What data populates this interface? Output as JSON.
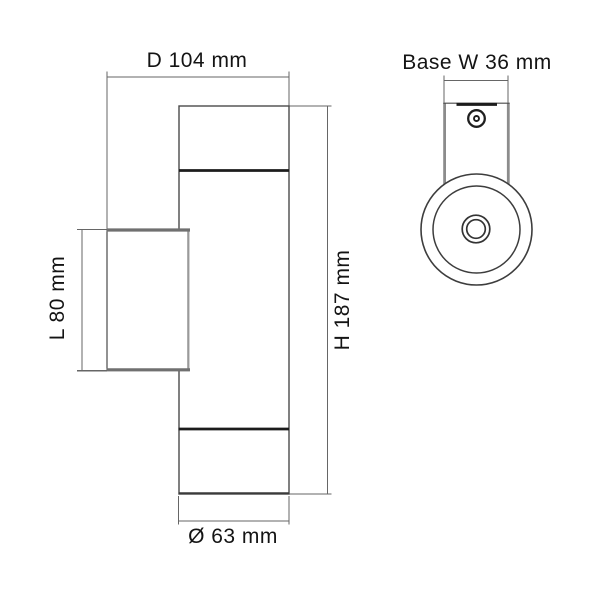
{
  "drawing": {
    "type": "technical-dimension-drawing",
    "subject": "cylindrical up-down wall luminaire, side view and front view",
    "side_view": {
      "dim_depth": "D 104 mm",
      "dim_length": "L 80 mm",
      "dim_height": "H 187 mm",
      "dim_diameter": "Ø 63 mm"
    },
    "front_view": {
      "dim_base_width": "Base W 36 mm"
    },
    "colors": {
      "background": "#ffffff",
      "outline": "#4a4a4a",
      "emphasis_line": "#1c1c1c",
      "shaded_edge": "#8c8c8c",
      "dimension_line": "#666666",
      "text": "#141414"
    }
  }
}
